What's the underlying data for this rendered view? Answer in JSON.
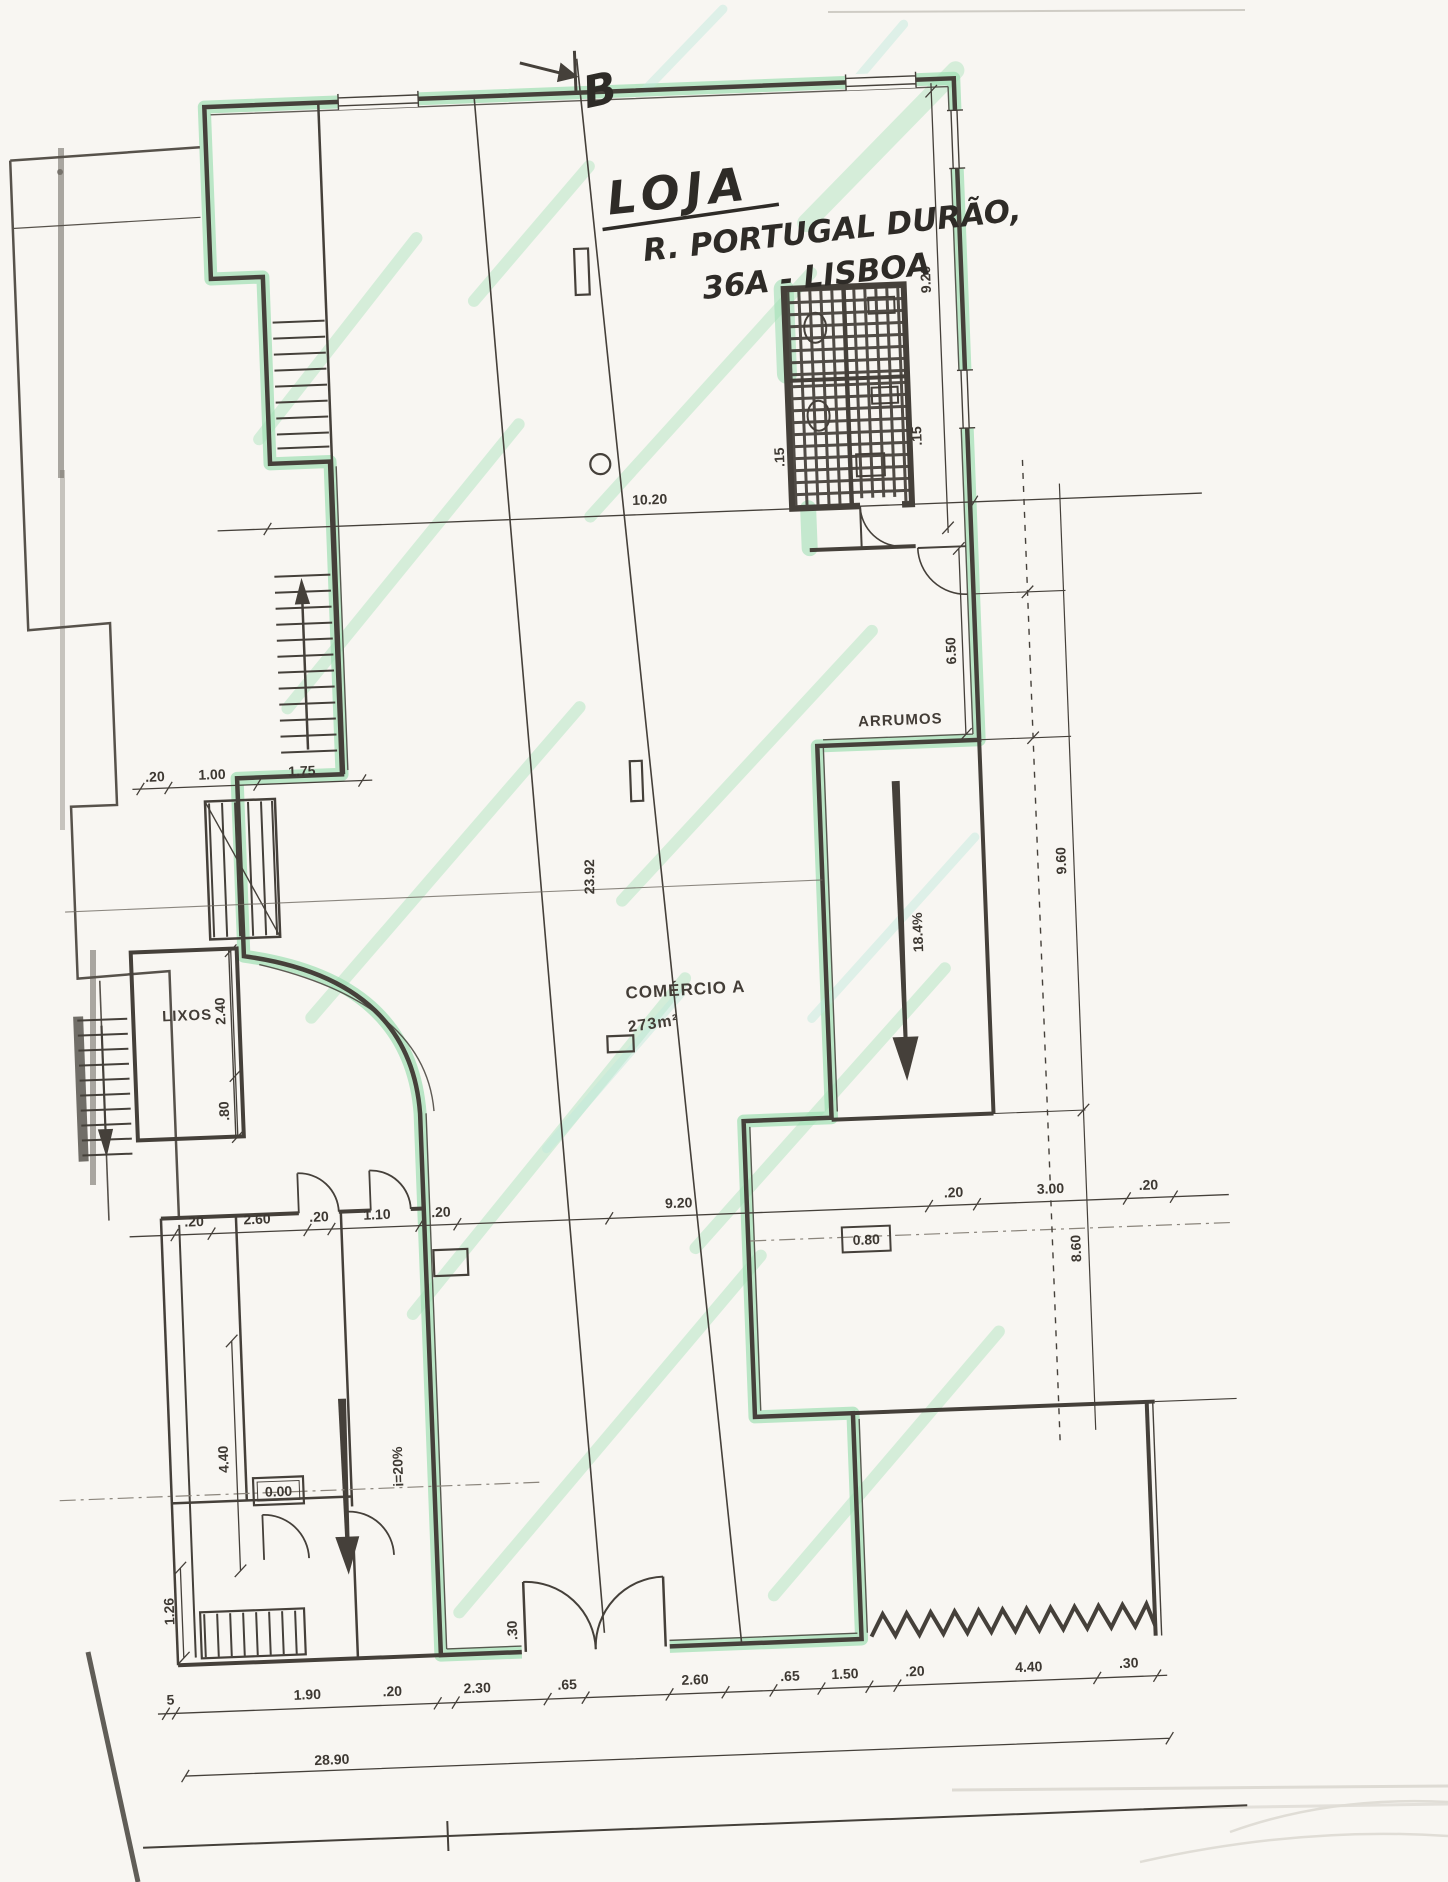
{
  "sheet": {
    "title_line1": "LOJA",
    "title_line2": "R. PORTUGAL DURÃO,",
    "title_line3": "36A - LISBOA",
    "section_marker": "B"
  },
  "rooms": {
    "storage": "ARRUMOS",
    "shop_name": "COMÉRCIO A",
    "shop_area": "273m²",
    "trash": "LIXOS"
  },
  "levels": {
    "interior": "0.00",
    "right_block": "0.80"
  },
  "slopes": {
    "left_ramp": "i=20%",
    "right_ramp": "18.4%"
  },
  "dims": {
    "top_width": "10.20",
    "right_wall": "9.20",
    "storage_depth": "6.50",
    "right_col_upper": "9.60",
    "right_col_lower": "8.60",
    "section_depth": "23.92",
    "left_chain": [
      ".20",
      "1.00",
      "1.75"
    ],
    "mid_chain": [
      ".20",
      "2.60",
      ".20",
      "1.10",
      ".20",
      "9.20",
      ".20",
      "3.00",
      ".20"
    ],
    "bottom_chain": [
      "5",
      "1.90",
      ".20",
      "2.30",
      ".65",
      "2.60",
      ".65",
      "1.50",
      ".20",
      "4.40",
      ".30"
    ],
    "overall_width": "28.90",
    "lixos_depth": "2.40",
    "lixos_small": ".80",
    "stair_depth": "4.40",
    "bottom_left": "1.26",
    "door_jamb": ".30",
    "wc_wall_a": ".15",
    "wc_wall_b": ".15"
  },
  "colors": {
    "highlight_green": "#86d8a2",
    "streak_green": "#9fe0b4",
    "streak_cyan": "#bfe9dc",
    "ink": "#45403a",
    "paper": "#f8f6f2"
  }
}
